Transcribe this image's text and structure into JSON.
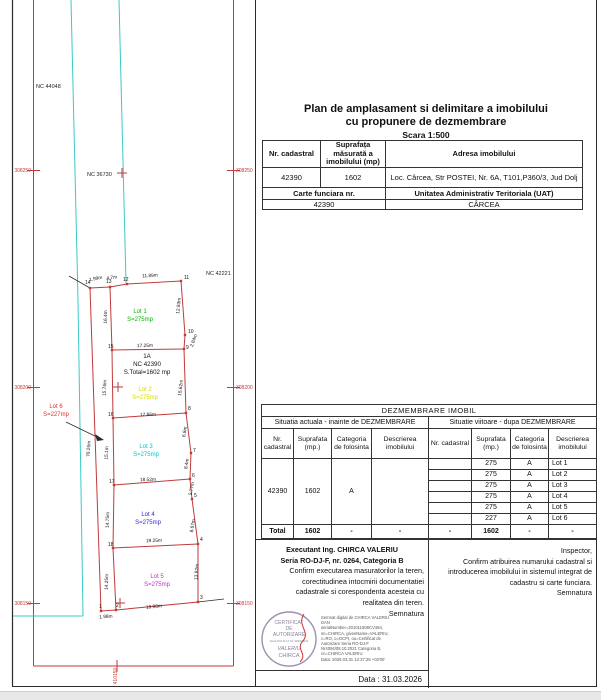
{
  "title": {
    "line1": "Plan de amplasament si delimitare a imobilului",
    "line2": "cu propunere de dezmembrare",
    "scale": "Scara 1:500"
  },
  "property_table": {
    "col1_header": "Nr. cadastral",
    "col2_header": "Suprafața măsurată a imobilului (mp)",
    "col3_header": "Adresa imobilului",
    "nr_cadastral": "42390",
    "suprafata": "1602",
    "adresa": "Loc. Cârcea, Str POSTEI, Nr. 6A, T101,P360/3, Jud Dolj",
    "carte_funciara_label": "Carte funciara nr.",
    "uat_label": "Unitatea Administrativ Teritoriala (UAT)",
    "carte_funciara_nr": "42390",
    "uat": "CÂRCEA"
  },
  "dezmembrare_table": {
    "title": "DEZMEMBRARE  IMOBIL",
    "left_header": "Situatia actuala - inainte de DEZMEMBRARE",
    "right_header": "Situatie viitoare - dupa DEZMEMBRARE",
    "columns": [
      "Nr. cadastral",
      "Suprafata (mp.)",
      "Categoria de folosinta",
      "Descrierea imobilului"
    ],
    "current": {
      "nr": "42390",
      "suprafata": "1602",
      "categoria": "A",
      "descriere": ""
    },
    "future_rows": [
      {
        "nr": "",
        "suprafata": "275",
        "categoria": "A",
        "descriere": "Lot 1"
      },
      {
        "nr": "",
        "suprafata": "275",
        "categoria": "A",
        "descriere": "Lot 2"
      },
      {
        "nr": "",
        "suprafata": "275",
        "categoria": "A",
        "descriere": "Lot 3"
      },
      {
        "nr": "",
        "suprafata": "275",
        "categoria": "A",
        "descriere": "Lot 4"
      },
      {
        "nr": "",
        "suprafata": "275",
        "categoria": "A",
        "descriere": "Lot 5"
      },
      {
        "nr": "",
        "suprafata": "227",
        "categoria": "A",
        "descriere": "Lot 6"
      }
    ],
    "total": {
      "label": "Total",
      "l_sup": "1602",
      "l_cat": "-",
      "l_desc": "-",
      "r_nr": "-",
      "r_sup": "1602",
      "r_cat": "-",
      "r_desc": "-"
    }
  },
  "executant": {
    "line1": "Executant Ing. CHIRCA  VALERIU",
    "line2": "Seria RO-DJ-F, nr. 0264, Categoria B",
    "body": [
      "Confirm executarea masuratorilor la teren,",
      "corectitudinea intocmirii documentatiei",
      "cadastrale si corespondenta acesteia cu",
      "realitatea din teren."
    ],
    "semnatura": "Semnatura",
    "data_line": "Data : 31.03.2026",
    "stamp": {
      "l1": "CERTIFICAT",
      "l2": "DE",
      "l3": "AUTORIZARE",
      "l4": "Seria RO-DJ-F Nr 4094/2021",
      "l5": "VALERIU",
      "l6": "CHIRCA"
    },
    "digital_signature": [
      "Semnat digital de CHIRCA VALERIU",
      "DAN",
      "serialNumber=201011508CV494,",
      "sn=CHIRCA, givenName=VALERIU,",
      "c=RO, o=OCPI, ou=Certificat de",
      "Autorizare Seria RO-DJ-F",
      "Nr4094/08.10.2021 Categoria B,",
      "cn=CHIRCA VALERIU",
      "Data: 2026.03.31 12:37:29 +03'00'"
    ]
  },
  "inspector": {
    "title": "Inspector,",
    "body": [
      "Confirm atribuirea numarului cadastral si",
      "introducerea imobilului in sistemul integrat de",
      "cadastru si carte funciara."
    ],
    "semnatura": "Semnatura"
  },
  "map": {
    "colors": {
      "boundary_red": "#c23a3a",
      "grid_red": "#c23a3a",
      "utility_cyan": "#3cc8c8",
      "frame_black": "#2a2a2a"
    },
    "nc_labels": [
      {
        "t": "NC 44048",
        "x": 36,
        "y": 88
      },
      {
        "t": "NC 36730",
        "x": 87,
        "y": 176
      },
      {
        "t": "NC 42221",
        "x": 206,
        "y": 275
      }
    ],
    "grid_labels": [
      {
        "t": "308250",
        "x": 31,
        "y": 172,
        "a": "end"
      },
      {
        "t": "308250",
        "x": 236,
        "y": 172,
        "a": "start"
      },
      {
        "t": "308200",
        "x": 31,
        "y": 389,
        "a": "end"
      },
      {
        "t": "308200",
        "x": 236,
        "y": 389,
        "a": "start"
      },
      {
        "t": "308150",
        "x": 31,
        "y": 605,
        "a": "end"
      },
      {
        "t": "308150",
        "x": 236,
        "y": 605,
        "a": "start"
      },
      {
        "t": "410150",
        "x": 117,
        "y": 676,
        "a": "middle",
        "r": -90
      }
    ],
    "lot_labels": [
      {
        "name": "Lot 1",
        "area": "S=275mp",
        "x": 140,
        "y": 313,
        "c": "#00b400"
      },
      {
        "name": "Lot 2",
        "area": "S=275mp",
        "x": 145,
        "y": 391,
        "c": "#d8d800"
      },
      {
        "name": "Lot 3",
        "area": "S=275mp",
        "x": 146,
        "y": 448,
        "c": "#00c8c8"
      },
      {
        "name": "Lot 4",
        "area": "S=275mp",
        "x": 148,
        "y": 516,
        "c": "#2a2ad0"
      },
      {
        "name": "Lot 5",
        "area": "S=275mp",
        "x": 157,
        "y": 578,
        "c": "#cc29cc"
      },
      {
        "name": "Lot 6",
        "area": "S=227mp",
        "x": 56,
        "y": 408,
        "c": "#e03030"
      }
    ],
    "parcel_label": {
      "lines": [
        "1A",
        "NC 42390",
        "S.Total=1602 mp"
      ],
      "x": 147,
      "y": 358
    },
    "measurements": [
      {
        "t": "1.99m",
        "x": 96,
        "y": 280,
        "r": -12
      },
      {
        "t": "4.7m",
        "x": 112,
        "y": 279,
        "r": -8
      },
      {
        "t": "11.89m",
        "x": 150,
        "y": 277,
        "r": -3
      },
      {
        "t": "12.93m",
        "x": 180,
        "y": 306,
        "r": -84
      },
      {
        "t": "2.84m",
        "x": 195,
        "y": 341,
        "r": -70
      },
      {
        "t": "16.4m",
        "x": 107,
        "y": 317,
        "r": -89
      },
      {
        "t": "17.25m",
        "x": 145,
        "y": 347,
        "r": -1
      },
      {
        "t": "15.76m",
        "x": 106,
        "y": 388,
        "r": -87
      },
      {
        "t": "15.62m",
        "x": 182,
        "y": 388,
        "r": -83
      },
      {
        "t": "17.86m",
        "x": 148,
        "y": 416,
        "r": -2
      },
      {
        "t": "15.1m",
        "x": 108,
        "y": 453,
        "r": -87
      },
      {
        "t": "6.8m",
        "x": 186,
        "y": 432,
        "r": -80
      },
      {
        "t": "8.4m",
        "x": 188,
        "y": 464,
        "r": -80
      },
      {
        "t": "18.52m",
        "x": 148,
        "y": 481,
        "r": -2
      },
      {
        "t": "5.77m",
        "x": 193,
        "y": 489,
        "r": -78
      },
      {
        "t": "14.75m",
        "x": 109,
        "y": 520,
        "r": -88
      },
      {
        "t": "8.67m",
        "x": 194,
        "y": 526,
        "r": -80
      },
      {
        "t": "19.25m",
        "x": 154,
        "y": 542,
        "r": -2
      },
      {
        "t": "14.25m",
        "x": 108,
        "y": 582,
        "r": -88
      },
      {
        "t": "13.82m",
        "x": 198,
        "y": 572,
        "r": -86
      },
      {
        "t": "19.98m",
        "x": 154,
        "y": 608,
        "r": -5
      },
      {
        "t": "1.98m",
        "x": 106,
        "y": 618,
        "r": -4
      },
      {
        "t": "70.26m",
        "x": 90,
        "y": 449,
        "r": -86
      }
    ],
    "points": [
      {
        "n": "1",
        "x": 99,
        "y": 608
      },
      {
        "n": "2",
        "x": 116,
        "y": 607
      },
      {
        "n": "3",
        "x": 200,
        "y": 599
      },
      {
        "n": "4",
        "x": 200,
        "y": 541
      },
      {
        "n": "5",
        "x": 194,
        "y": 497
      },
      {
        "n": "6",
        "x": 192,
        "y": 477
      },
      {
        "n": "7",
        "x": 193,
        "y": 452
      },
      {
        "n": "8",
        "x": 188,
        "y": 410
      },
      {
        "n": "9",
        "x": 186,
        "y": 349
      },
      {
        "n": "10",
        "x": 188,
        "y": 333
      },
      {
        "n": "11",
        "x": 184,
        "y": 279
      },
      {
        "n": "12",
        "x": 123,
        "y": 281
      },
      {
        "n": "13",
        "x": 106,
        "y": 283
      },
      {
        "n": "14",
        "x": 85,
        "y": 284
      },
      {
        "n": "15",
        "x": 108,
        "y": 348
      },
      {
        "n": "16",
        "x": 108,
        "y": 416
      },
      {
        "n": "17",
        "x": 109,
        "y": 483
      },
      {
        "n": "18",
        "x": 108,
        "y": 546
      }
    ]
  }
}
